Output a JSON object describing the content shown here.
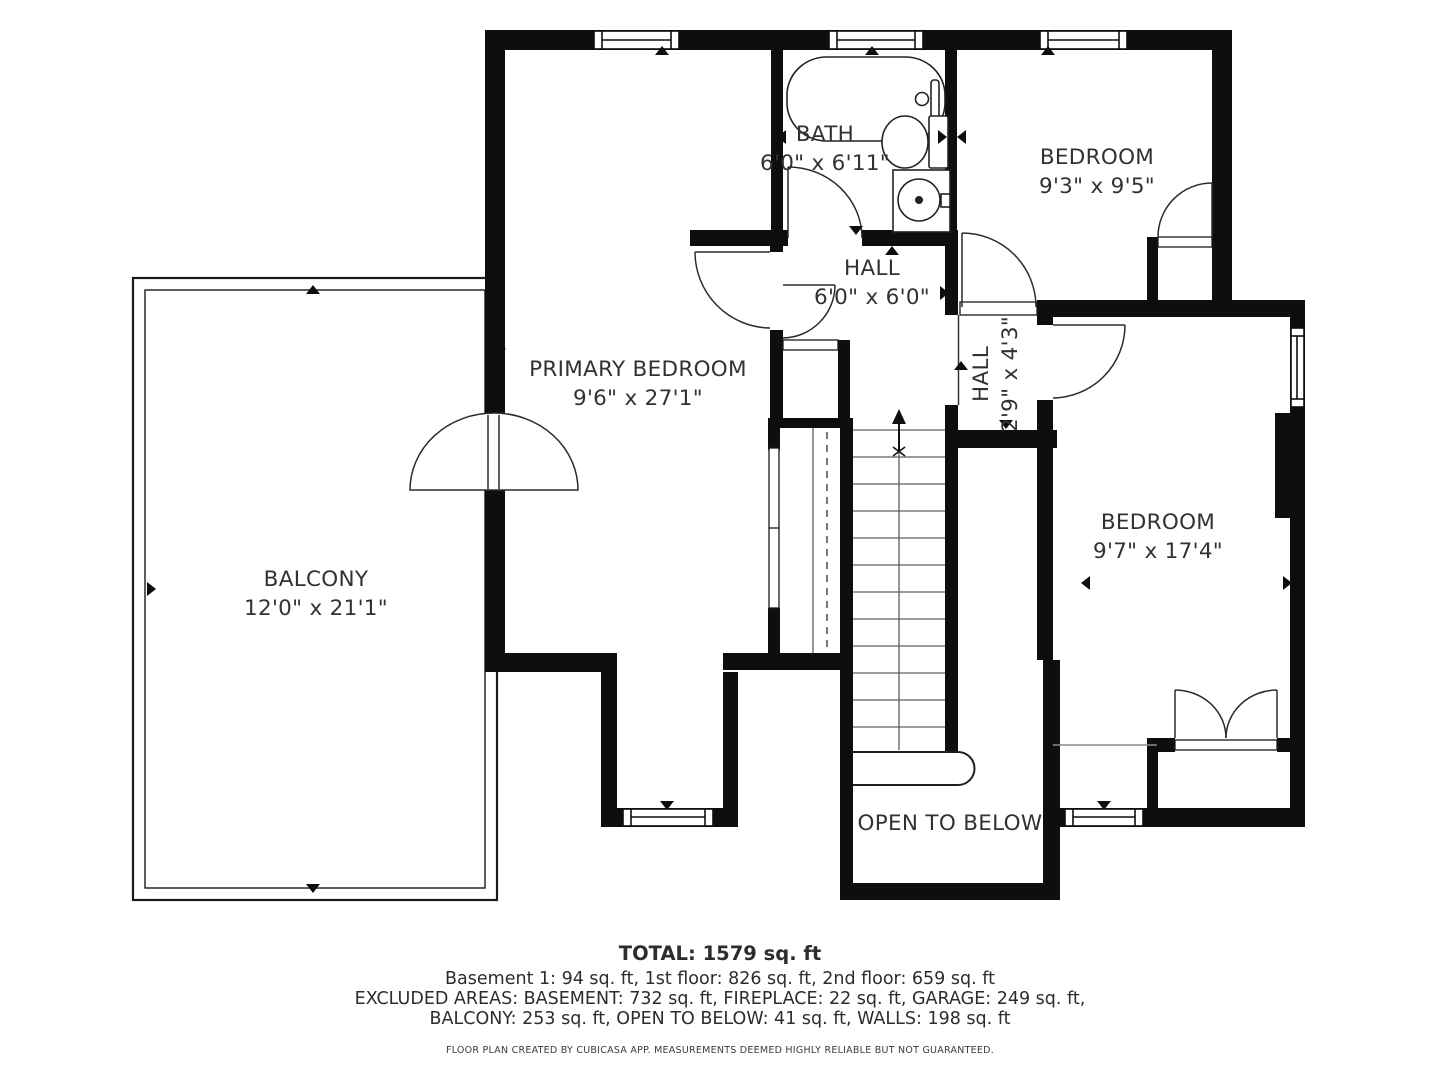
{
  "floorplan": {
    "rooms": {
      "bath": {
        "name": "BATH",
        "dims": "6'0\" x 6'11\""
      },
      "bedroom_top": {
        "name": "BEDROOM",
        "dims": "9'3\" x 9'5\""
      },
      "hall": {
        "name": "HALL",
        "dims": "6'0\" x 6'0\""
      },
      "hall_small": {
        "name": "HALL",
        "dims": "2'9\" x 4'3\""
      },
      "primary_bedroom": {
        "name": "PRIMARY BEDROOM",
        "dims": "9'6\" x 27'1\""
      },
      "balcony": {
        "name": "BALCONY",
        "dims": "12'0\" x 21'1\""
      },
      "bedroom_right": {
        "name": "BEDROOM",
        "dims": "9'7\" x 17'4\""
      },
      "open_to_below": {
        "name": "OPEN TO BELOW"
      }
    },
    "summary": {
      "total": "TOTAL: 1579 sq. ft",
      "floors": "Basement 1: 94 sq. ft, 1st floor: 826 sq. ft, 2nd floor: 659 sq. ft",
      "excluded1": "EXCLUDED AREAS: BASEMENT: 732 sq. ft, FIREPLACE: 22 sq. ft, GARAGE: 249 sq. ft,",
      "excluded2": "BALCONY: 253 sq. ft, OPEN TO BELOW: 41 sq. ft, WALLS: 198 sq. ft",
      "disclaimer": "FLOOR PLAN CREATED BY CUBICASA APP. MEASUREMENTS DEEMED HIGHLY RELIABLE BUT NOT GUARANTEED."
    },
    "colors": {
      "wall": "#0e0e0e",
      "label": "#323232",
      "tread": "#5f5f5f"
    }
  }
}
